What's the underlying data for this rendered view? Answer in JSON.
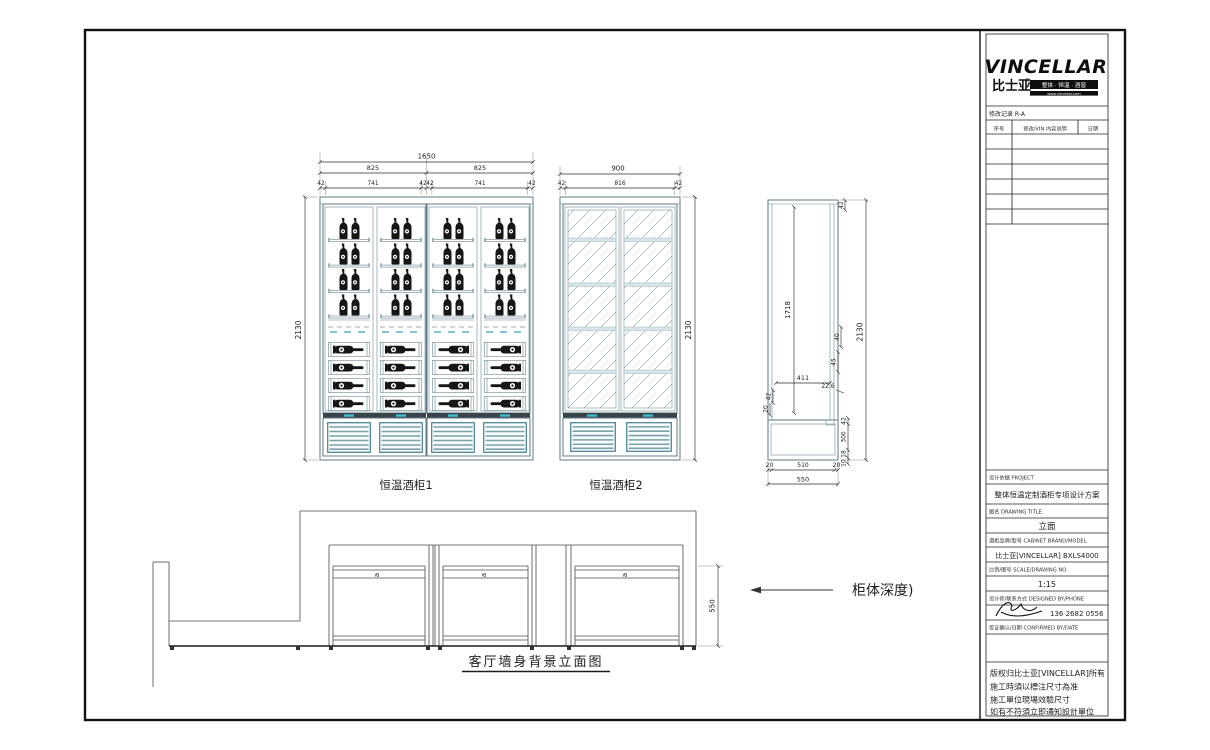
{
  "colors": {
    "cabinet_linework": "#5c7a84",
    "dimension_line": "#2b2b2b",
    "louver_frame": "#4f8696",
    "handle_accent": "#3fc1d1",
    "bottle": "#161616"
  },
  "title_block": {
    "logo": {
      "brand": "VINCELLAR",
      "brand_cn": "比士亚",
      "reg": "®",
      "tagline": "整体 · 恒温 · 酒窖",
      "website": "www.vincellar.com"
    },
    "revision": {
      "title": "修改记录 R-A",
      "col_no": "序号",
      "col_desc": "修改/VIN 内容说明",
      "col_date": "日期"
    },
    "sections": [
      {
        "label": "设计依据 PROJECT",
        "value": "整体恒温定制酒柜专项设计方案"
      },
      {
        "label": "图名 DRAWING TITLE",
        "value": "立面"
      },
      {
        "label": "酒柜品牌/型号 CABINET BRAND/MODEL",
        "value": "比士亚[VINCELLAR] BXLS4000"
      },
      {
        "label": "比例/图号 SCALE/DRAWING NO.",
        "value": "1:15"
      },
      {
        "label": "设计师/联系方式 DESIGNED BY/PHONE",
        "value": "136 2682 0556"
      },
      {
        "label": "签证确认/日期 CONFIRMED BY/DATE",
        "value": ""
      }
    ],
    "notes": [
      "版权归比士亚[VINCELLAR]所有",
      "施工時須以標注尺寸為准",
      "施工單位現場效驗尺寸",
      "如有不符須立即通知設計單位"
    ]
  },
  "drawing": {
    "cab1": {
      "label": "恒温酒柜1",
      "total": "1650",
      "half_a": "825",
      "half_b": "825",
      "sub": [
        "42",
        "741",
        "42",
        "42",
        "741",
        "42"
      ],
      "height": "2130"
    },
    "cab2": {
      "label": "恒温酒柜2",
      "total": "900",
      "sub": [
        "42",
        "816",
        "42"
      ],
      "height": "2130"
    },
    "side": {
      "top": "42",
      "inner_height": "1718",
      "height": "2130",
      "depth_inner": "411",
      "f40": "40",
      "f45": "45",
      "f226": "22.6",
      "bl42": "42",
      "bl20": "20",
      "br42": "42",
      "br300": "300",
      "br18": "18",
      "br10": "10",
      "bottom": [
        "20",
        "510",
        "20"
      ],
      "total_depth": "550"
    },
    "plan": {
      "title": "客厅墙身背景立面图",
      "depth": "550",
      "note": "柜体深度)",
      "door_mark": "a"
    }
  }
}
